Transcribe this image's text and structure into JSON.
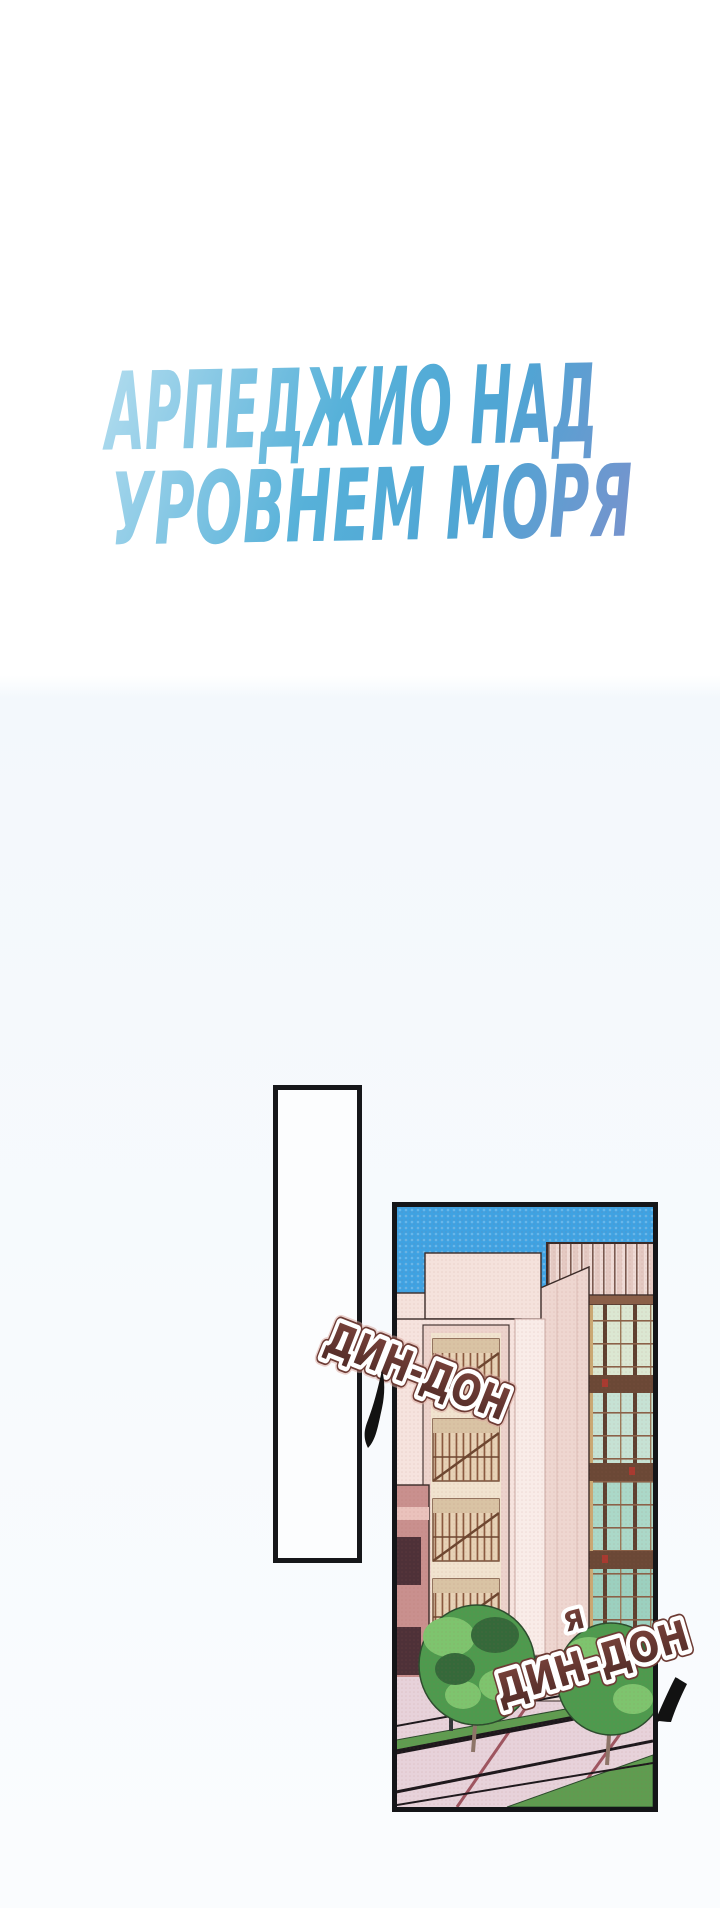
{
  "title": {
    "line1": "АРПЕДЖИО НАД",
    "line2": "УРОВНЕМ МОРЯ"
  },
  "sfx": {
    "first": "ДИН-ДОН",
    "second_prefix": "Я",
    "second": "ДИН-ДОН"
  },
  "palette": {
    "title_gradient_start": "#b7dff0",
    "title_gradient_mid": "#57b1d9",
    "title_gradient_end": "#7e90cc",
    "sfx_fill_top": "#7c443c",
    "sfx_fill_bottom": "#4e2a26",
    "sfx_outline": "#ffffff",
    "sfx_rim": "#6d3b34",
    "panel_border": "#141518",
    "sky_blue": "#3fa2e2",
    "facade_pink": "#f6e3de",
    "window_frame_tan": "#caa873",
    "glass_teal": "#abd8c8",
    "fire_escape_brown": "#8a5a40",
    "mauve_wall": "#c9908e",
    "plaza_pink": "#e7d2da",
    "grass_green": "#5f9c50",
    "tree_green": "#4e9a4e",
    "page_background_top": "#ffffff",
    "page_background_bottom": "#f7fafd"
  }
}
